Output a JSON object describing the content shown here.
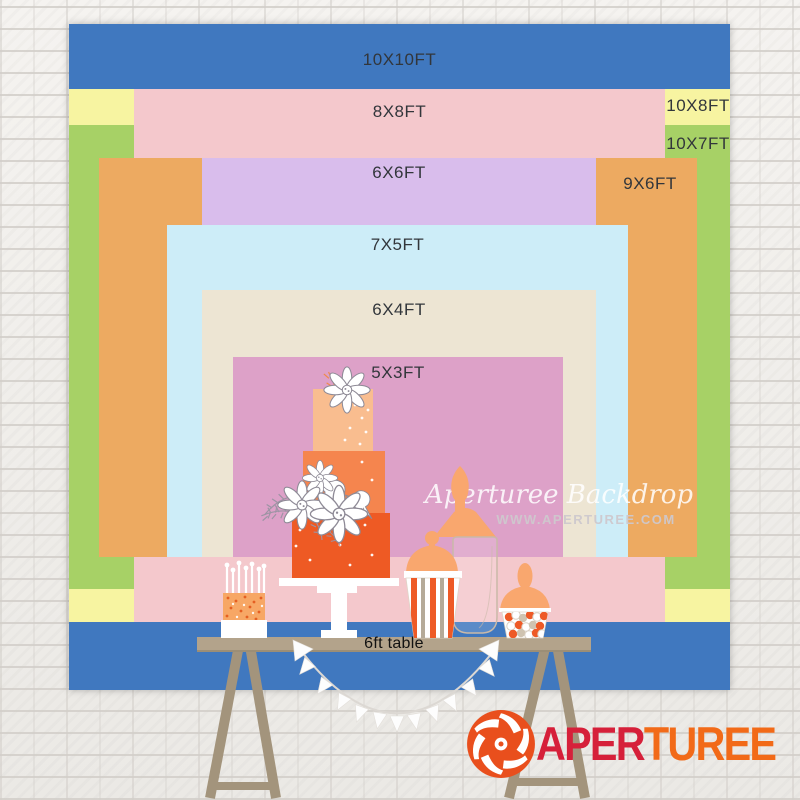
{
  "backdrop": {
    "sizes": [
      {
        "id": "10x10",
        "label": "10X10FT",
        "color": "#4078bf",
        "width_ft": 10,
        "height_ft": 10
      },
      {
        "id": "10x8",
        "label": "10X8FT",
        "color": "#f7f4a1",
        "width_ft": 10,
        "height_ft": 8
      },
      {
        "id": "10x7",
        "label": "10X7FT",
        "color": "#a7d166",
        "width_ft": 10,
        "height_ft": 7
      },
      {
        "id": "8x8",
        "label": "8X8FT",
        "color": "#f4c8cc",
        "width_ft": 8,
        "height_ft": 8
      },
      {
        "id": "9x6",
        "label": "9X6FT",
        "color": "#edaa61",
        "width_ft": 9,
        "height_ft": 6
      },
      {
        "id": "6x6",
        "label": "6X6FT",
        "color": "#d9bdec",
        "width_ft": 6,
        "height_ft": 6
      },
      {
        "id": "7x5",
        "label": "7X5FT",
        "color": "#cdedf8",
        "width_ft": 7,
        "height_ft": 5
      },
      {
        "id": "6x4",
        "label": "6X4FT",
        "color": "#ede5d3",
        "width_ft": 6,
        "height_ft": 4
      },
      {
        "id": "5x3",
        "label": "5X3FT",
        "color": "#dda1c8",
        "width_ft": 5,
        "height_ft": 3
      }
    ]
  },
  "table": {
    "label": "6ft table"
  },
  "watermark": {
    "script": "Aperturee Backdrop",
    "url": "WWW.APERTUREE.COM"
  },
  "logo": {
    "part_red": "APER",
    "part_orange": "TUREE"
  },
  "palette": {
    "cake_tier_bottom": "#ee5a24",
    "cake_tier_middle": "#f5854e",
    "cake_tier_top": "#f9bd8f",
    "peach_silhouette": "#f9a76e",
    "table_wood": "#b3a38b",
    "leg_wood": "#a3947c",
    "logo_red": "#d6203a",
    "logo_orange": "#f26a18",
    "blue_backdrop": "#4078bf"
  }
}
